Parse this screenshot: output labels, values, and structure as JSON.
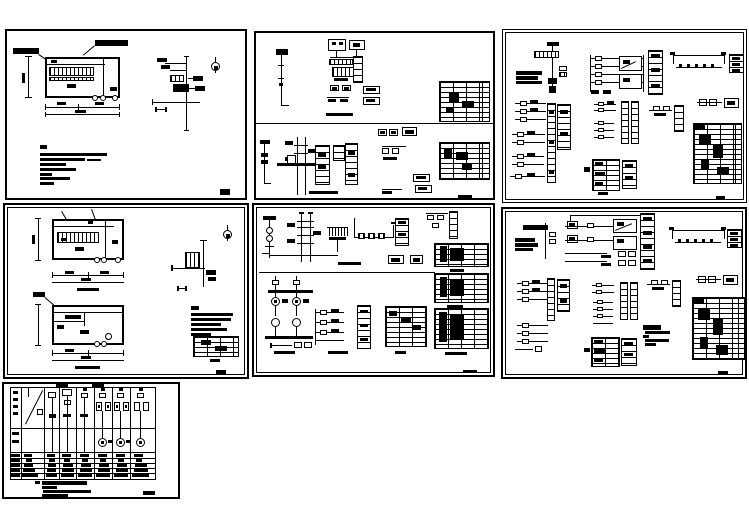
{
  "canvas": {
    "width": 749,
    "height": 530,
    "background_color": "#ffffff",
    "line_color": "#000000"
  },
  "text_rendering": "illegible-at-scale",
  "sheets": [
    {
      "id": "sheet-1",
      "name": "power room plan and installation detail",
      "position": "top-left",
      "features": [
        "floor-plan",
        "dimension-lines",
        "installation-detail",
        "north-arrow",
        "notes-block",
        "title-mark"
      ]
    },
    {
      "id": "sheet-2",
      "name": "distribution system diagrams",
      "position": "top-center",
      "features": [
        "single-line-diagrams",
        "terminal-strips",
        "equipment-schedule-tables"
      ]
    },
    {
      "id": "sheet-3",
      "name": "control schematics sheet A",
      "position": "top-right",
      "features": [
        "riser-diagram",
        "control-ladders",
        "contactor-circuits",
        "schedule-table"
      ]
    },
    {
      "id": "sheet-4",
      "name": "two floor plans with detail",
      "position": "middle-left",
      "features": [
        "floor-plans",
        "dimension-lines",
        "detail",
        "north-arrow",
        "notes-block",
        "schedule-table"
      ]
    },
    {
      "id": "sheet-5",
      "name": "control schematics sheet B",
      "position": "middle-center",
      "features": [
        "transformer-circuit",
        "motor-circuits",
        "ladder-diagram",
        "schedule-tables"
      ]
    },
    {
      "id": "sheet-6",
      "name": "control schematics sheet C",
      "position": "middle-right",
      "features": [
        "control-ladders",
        "contactor-circuits",
        "notes-block",
        "schedule-table"
      ]
    },
    {
      "id": "sheet-7",
      "name": "panel schedule with circuit columns",
      "position": "bottom-left",
      "features": [
        "circuit-columns",
        "motor-symbols",
        "data-rows",
        "notes-block"
      ]
    }
  ]
}
